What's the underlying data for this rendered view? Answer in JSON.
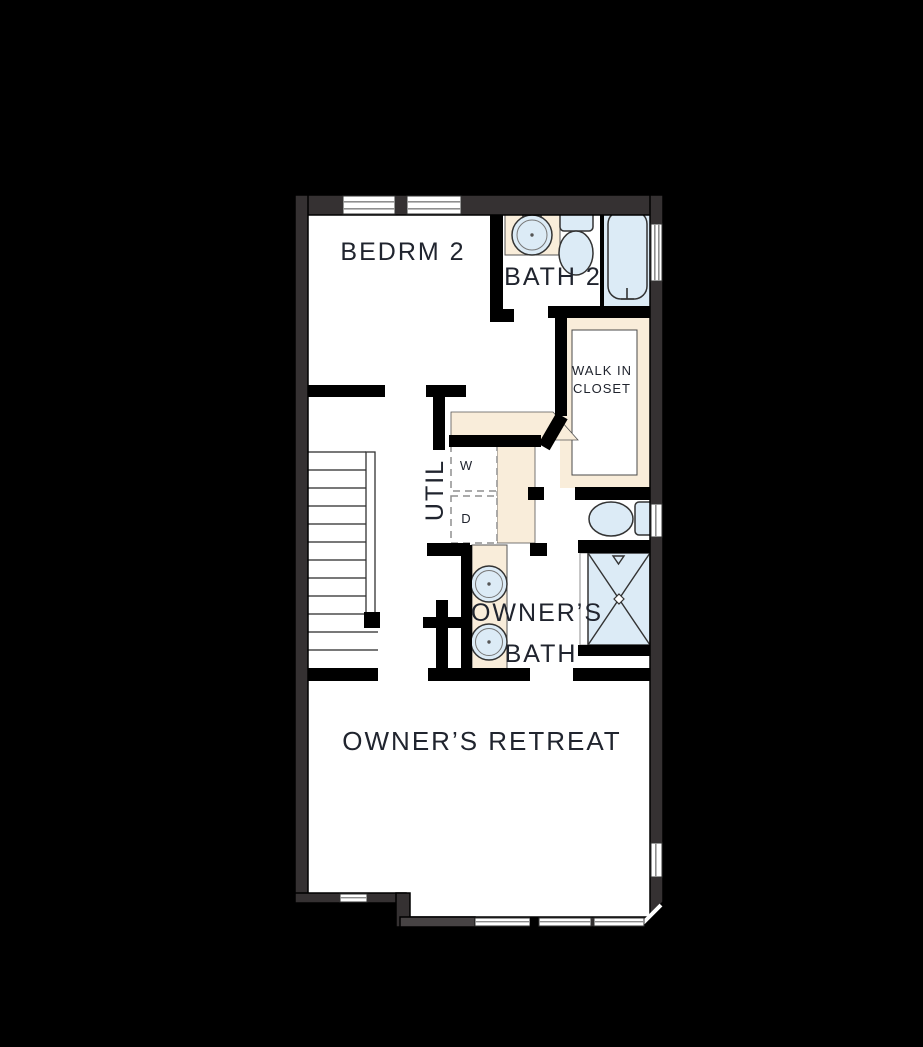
{
  "canvas": {
    "background": "#000000"
  },
  "plan": {
    "rooms": {
      "bedrm2": {
        "label": "BEDRM 2"
      },
      "bath2": {
        "label": "BATH 2"
      },
      "walk_in_closet": {
        "label_line1": "WALK IN",
        "label_line2": "CLOSET"
      },
      "util": {
        "label": "UTIL"
      },
      "owners_bath": {
        "label_line1": "OWNER’S",
        "label_line2": "BATH"
      },
      "owners_retreat": {
        "label": "OWNER’S RETREAT"
      }
    },
    "appliances": {
      "washer_label": "W",
      "dryer_label": "D"
    },
    "fixtures": [
      "bathtub",
      "toilet",
      "vanity-sink",
      "double-vanity-sinks",
      "shower",
      "washer",
      "dryer",
      "staircase",
      "walk-in-closet-shelving"
    ],
    "colors": {
      "wall_fill": "#353132",
      "wall_line": "#000000",
      "floor": "#ffffff",
      "casework_cream": "#f9edda",
      "fixture_blue": "#dcebf6",
      "label_text": "#20242e",
      "window_line": "#8f8f8f"
    }
  }
}
